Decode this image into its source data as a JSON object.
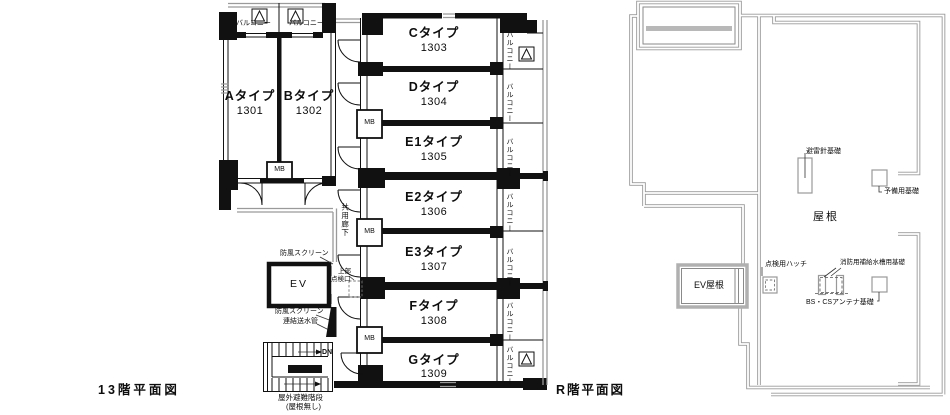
{
  "left_plan": {
    "title": "13階平面図",
    "units_ab": [
      {
        "type": "Aタイプ",
        "number": "1301"
      },
      {
        "type": "Bタイプ",
        "number": "1302"
      }
    ],
    "units_main": [
      {
        "type": "Cタイプ",
        "number": "1303"
      },
      {
        "type": "Dタイプ",
        "number": "1304"
      },
      {
        "type": "E1タイプ",
        "number": "1305"
      },
      {
        "type": "E2タイプ",
        "number": "1306"
      },
      {
        "type": "E3タイプ",
        "number": "1307"
      },
      {
        "type": "Fタイプ",
        "number": "1308"
      },
      {
        "type": "Gタイプ",
        "number": "1309"
      }
    ],
    "labels": {
      "balcony": "バルコニー",
      "mb": "MB",
      "ev": "EV",
      "corridor": "共用廊下",
      "wind_screen": "防風スクリーン",
      "upper_inspection_l1": "上部",
      "upper_inspection_l2": "点検口",
      "standpipe": "連結送水管",
      "down": "DN",
      "outdoor_stair": "屋外避難階段",
      "no_roof": "(屋根無し)"
    }
  },
  "right_plan": {
    "title": "R階平面図",
    "labels": {
      "roof": "屋根",
      "ev_roof": "EV屋根",
      "lightning_rod_base": "避雷針基礎",
      "reserve_base": "予備用基礎",
      "inspection_hatch": "点検用ハッチ",
      "fire_water_tank_base": "消防用補給水槽用基礎",
      "bs_cs_antenna_base": "BS・CSアンテナ基礎"
    }
  },
  "colors": {
    "wall": "#111111",
    "rail_gray": "#9a9a9a",
    "roof_line": "#8a8a8a",
    "background": "#ffffff"
  }
}
